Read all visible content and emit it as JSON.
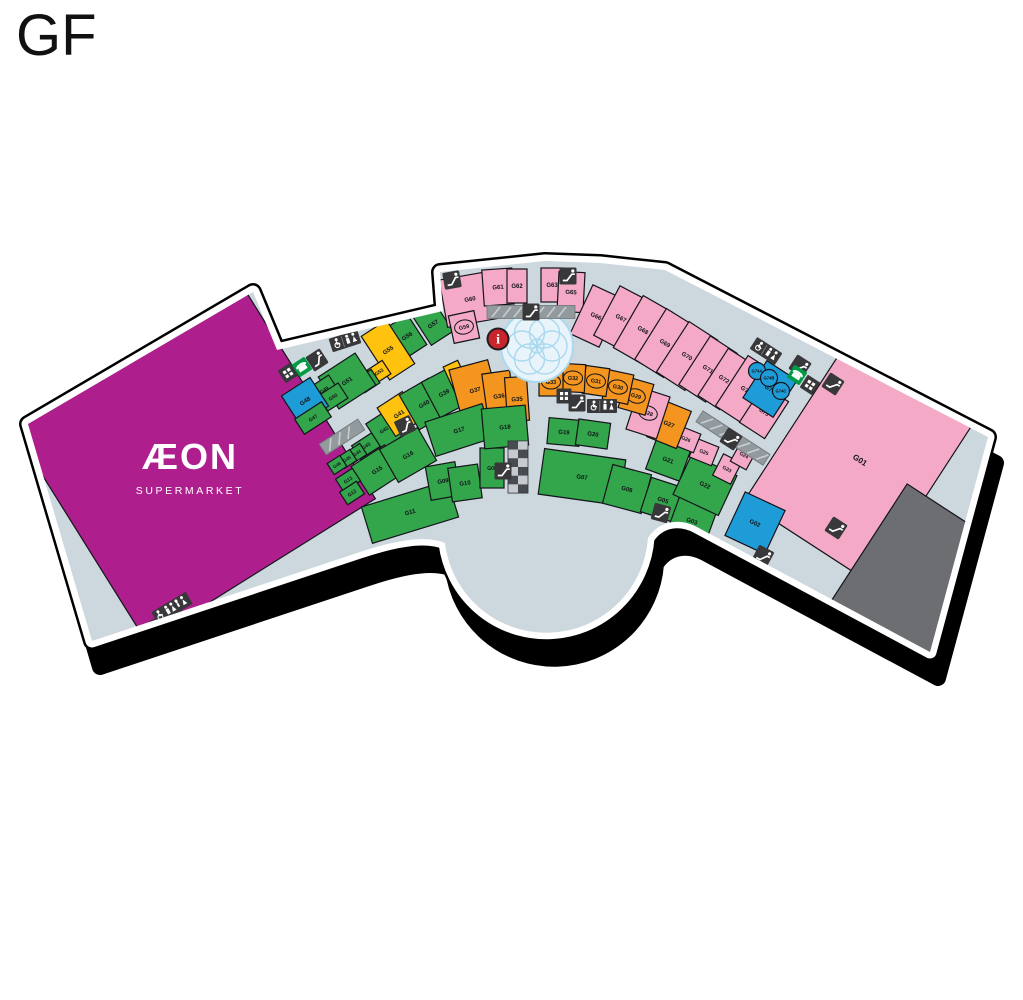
{
  "title": "GF",
  "aeon": {
    "name": "ÆON",
    "sub": "SUPERMARKET"
  },
  "colors": {
    "g": "#33a54b",
    "p": "#f4aac7",
    "o": "#f3951f",
    "y": "#ffc20e",
    "b": "#1e9cd7",
    "m": "#ae1e8d",
    "gr": "#6d6e71",
    "floor": "#ccd7de",
    "shadow": "#000000",
    "slab": "#ffffff",
    "iconDark": "#38383a",
    "phoneGreen": "#009a44",
    "infoRed": "#c9252c",
    "ramp": "#929a9d",
    "fountain": "#a9d9ef"
  },
  "units": [
    {
      "id": "AEON",
      "x": 192,
      "y": 460,
      "w": 270,
      "h": 260,
      "r": -32,
      "c": "m"
    },
    {
      "id": "G01",
      "x": 860,
      "y": 460,
      "w": 150,
      "h": 195,
      "r": 33,
      "c": "p",
      "fs": 8
    },
    {
      "id": "",
      "x": 925,
      "y": 585,
      "w": 140,
      "h": 150,
      "r": 33,
      "c": "gr"
    },
    {
      "id": "G02",
      "x": 755,
      "y": 523,
      "w": 44,
      "h": 48,
      "r": 25,
      "c": "b"
    },
    {
      "id": "G57",
      "x": 433,
      "y": 324,
      "w": 26,
      "h": 34,
      "r": -33,
      "c": "g"
    },
    {
      "id": "G56",
      "x": 407,
      "y": 336,
      "w": 24,
      "h": 36,
      "r": -33,
      "c": "g"
    },
    {
      "id": "G55",
      "x": 388,
      "y": 350,
      "w": 30,
      "h": 52,
      "r": -33,
      "c": "y"
    },
    {
      "id": "G53",
      "x": 379,
      "y": 372,
      "w": 18,
      "h": 16,
      "r": -33,
      "c": "y",
      "fs": 5
    },
    {
      "id": "G52",
      "x": 368,
      "y": 381,
      "w": 18,
      "h": 16,
      "r": -33,
      "c": "g",
      "fs": 5
    },
    {
      "id": "G51",
      "x": 347,
      "y": 381,
      "w": 44,
      "h": 38,
      "r": -33,
      "c": "g"
    },
    {
      "id": "G49",
      "x": 324,
      "y": 390,
      "w": 24,
      "h": 20,
      "r": -33,
      "c": "g",
      "fs": 5
    },
    {
      "id": "G50",
      "x": 333,
      "y": 397,
      "w": 24,
      "h": 18,
      "r": -33,
      "c": "g",
      "fs": 5
    },
    {
      "id": "G48",
      "x": 305,
      "y": 401,
      "w": 34,
      "h": 34,
      "r": -33,
      "c": "b"
    },
    {
      "id": "G47",
      "x": 313,
      "y": 418,
      "w": 32,
      "h": 18,
      "r": -33,
      "c": "g",
      "fs": 5
    },
    {
      "id": "G43",
      "x": 366,
      "y": 446,
      "w": 24,
      "h": 16,
      "r": -33,
      "c": "g",
      "fs": 5
    },
    {
      "id": "G44",
      "x": 357,
      "y": 453,
      "w": 15,
      "h": 13,
      "r": -33,
      "c": "g",
      "fs": 4.5
    },
    {
      "id": "G45",
      "x": 347,
      "y": 459,
      "w": 15,
      "h": 13,
      "r": -33,
      "c": "g",
      "fs": 4.5
    },
    {
      "id": "G46",
      "x": 337,
      "y": 465,
      "w": 15,
      "h": 13,
      "r": -33,
      "c": "g",
      "fs": 4.5
    },
    {
      "id": "G42",
      "x": 384,
      "y": 430,
      "w": 24,
      "h": 30,
      "r": -33,
      "c": "g",
      "fs": 5
    },
    {
      "id": "G41",
      "x": 399,
      "y": 414,
      "w": 30,
      "h": 34,
      "r": -33,
      "c": "y"
    },
    {
      "id": "G40",
      "x": 424,
      "y": 404,
      "w": 34,
      "h": 40,
      "r": -30,
      "c": "g"
    },
    {
      "id": "G39",
      "x": 444,
      "y": 393,
      "w": 30,
      "h": 40,
      "r": -28,
      "c": "g"
    },
    {
      "id": "G38",
      "x": 458,
      "y": 380,
      "w": 16,
      "h": 36,
      "r": -25,
      "c": "y",
      "fs": 5
    },
    {
      "id": "G37",
      "x": 475,
      "y": 390,
      "w": 40,
      "h": 52,
      "r": -15,
      "c": "o"
    },
    {
      "id": "G36",
      "x": 499,
      "y": 396,
      "w": 28,
      "h": 48,
      "r": -8,
      "c": "o"
    },
    {
      "id": "G35",
      "x": 517,
      "y": 399,
      "w": 22,
      "h": 44,
      "r": -4,
      "c": "o"
    },
    {
      "id": "G15",
      "x": 377,
      "y": 470,
      "w": 40,
      "h": 34,
      "r": -33,
      "c": "g"
    },
    {
      "id": "G13",
      "x": 348,
      "y": 480,
      "w": 20,
      "h": 15,
      "r": -33,
      "c": "g",
      "fs": 5
    },
    {
      "id": "G12",
      "x": 352,
      "y": 493,
      "w": 20,
      "h": 15,
      "r": -33,
      "c": "g",
      "fs": 5
    },
    {
      "id": "G16",
      "x": 408,
      "y": 455,
      "w": 44,
      "h": 38,
      "r": -30,
      "c": "g"
    },
    {
      "id": "G11",
      "x": 410,
      "y": 512,
      "w": 90,
      "h": 38,
      "r": -17,
      "c": "g"
    },
    {
      "id": "G09",
      "x": 443,
      "y": 481,
      "w": 30,
      "h": 34,
      "r": -10,
      "c": "g"
    },
    {
      "id": "G10",
      "x": 465,
      "y": 483,
      "w": 30,
      "h": 34,
      "r": -8,
      "c": "g"
    },
    {
      "id": "G08",
      "x": 492,
      "y": 468,
      "w": 24,
      "h": 40,
      "r": 0,
      "c": "g",
      "fs": 5
    },
    {
      "id": "G17",
      "x": 459,
      "y": 430,
      "w": 60,
      "h": 36,
      "r": -18,
      "c": "g"
    },
    {
      "id": "G18",
      "x": 505,
      "y": 427,
      "w": 44,
      "h": 40,
      "r": -5,
      "c": "g"
    },
    {
      "id": "G19",
      "x": 564,
      "y": 432,
      "w": 32,
      "h": 26,
      "r": 5,
      "c": "g"
    },
    {
      "id": "G20",
      "x": 593,
      "y": 434,
      "w": 32,
      "h": 26,
      "r": 8,
      "c": "g"
    },
    {
      "id": "G07",
      "x": 582,
      "y": 477,
      "w": 82,
      "h": 46,
      "r": 8,
      "c": "g"
    },
    {
      "id": "G06",
      "x": 627,
      "y": 489,
      "w": 40,
      "h": 40,
      "r": 15,
      "c": "g"
    },
    {
      "id": "G05",
      "x": 663,
      "y": 500,
      "w": 36,
      "h": 36,
      "r": 18,
      "c": "g"
    },
    {
      "id": "G03",
      "x": 692,
      "y": 521,
      "w": 40,
      "h": 40,
      "r": 20,
      "c": "g"
    },
    {
      "id": "G21",
      "x": 668,
      "y": 460,
      "w": 36,
      "h": 32,
      "r": 20,
      "c": "g"
    },
    {
      "id": "G22",
      "x": 705,
      "y": 485,
      "w": 50,
      "h": 44,
      "r": 25,
      "c": "g"
    },
    {
      "id": "G23",
      "x": 727,
      "y": 469,
      "w": 20,
      "h": 24,
      "r": 27,
      "c": "p",
      "fs": 5
    },
    {
      "id": "G24",
      "x": 744,
      "y": 455,
      "w": 18,
      "h": 24,
      "r": 29,
      "c": "p",
      "fs": 5
    },
    {
      "id": "G25",
      "x": 704,
      "y": 452,
      "w": 24,
      "h": 20,
      "r": 22,
      "c": "p",
      "fs": 5
    },
    {
      "id": "G26",
      "x": 686,
      "y": 439,
      "w": 24,
      "h": 20,
      "r": 22,
      "c": "p",
      "fs": 5
    },
    {
      "id": "G27",
      "x": 669,
      "y": 424,
      "w": 32,
      "h": 40,
      "r": 22,
      "c": "o"
    },
    {
      "id": "G28",
      "x": 648,
      "y": 413,
      "w": 32,
      "h": 44,
      "r": 18,
      "c": "p",
      "fs": 5.5,
      "ring": true
    },
    {
      "id": "G29",
      "x": 636,
      "y": 396,
      "w": 28,
      "h": 32,
      "r": 16,
      "c": "o",
      "fs": 5.5,
      "ring": true
    },
    {
      "id": "G30",
      "x": 618,
      "y": 387,
      "w": 26,
      "h": 30,
      "r": 12,
      "c": "o",
      "fs": 5.5,
      "ring": true
    },
    {
      "id": "G31",
      "x": 596,
      "y": 381,
      "w": 24,
      "h": 28,
      "r": 8,
      "c": "o",
      "fs": 5.5,
      "ring": true
    },
    {
      "id": "G32",
      "x": 573,
      "y": 378,
      "w": 24,
      "h": 28,
      "r": 3,
      "c": "o",
      "fs": 5.5,
      "ring": true
    },
    {
      "id": "G33",
      "x": 551,
      "y": 382,
      "w": 24,
      "h": 28,
      "r": 0,
      "c": "o",
      "fs": 5.5,
      "ring": true
    },
    {
      "id": "G60",
      "x": 470,
      "y": 299,
      "w": 54,
      "h": 48,
      "r": -10,
      "c": "p"
    },
    {
      "id": "G59",
      "x": 464,
      "y": 327,
      "w": 26,
      "h": 28,
      "r": -12,
      "c": "p",
      "fs": 5.5,
      "ring": true
    },
    {
      "id": "G61",
      "x": 498,
      "y": 287,
      "w": 30,
      "h": 36,
      "r": -4,
      "c": "p"
    },
    {
      "id": "G62",
      "x": 517,
      "y": 286,
      "w": 20,
      "h": 34,
      "r": 0,
      "c": "p"
    },
    {
      "id": "G63",
      "x": 552,
      "y": 285,
      "w": 22,
      "h": 34,
      "r": 0,
      "c": "p"
    },
    {
      "id": "G65",
      "x": 571,
      "y": 292,
      "w": 26,
      "h": 40,
      "r": 3,
      "c": "p"
    },
    {
      "id": "G66",
      "x": 596,
      "y": 316,
      "w": 32,
      "h": 54,
      "r": 25,
      "c": "p"
    },
    {
      "id": "G67",
      "x": 621,
      "y": 318,
      "w": 32,
      "h": 56,
      "r": 28,
      "c": "p"
    },
    {
      "id": "G68",
      "x": 643,
      "y": 330,
      "w": 34,
      "h": 60,
      "r": 30,
      "c": "p"
    },
    {
      "id": "G69",
      "x": 665,
      "y": 343,
      "w": 34,
      "h": 60,
      "r": 32,
      "c": "p"
    },
    {
      "id": "G70",
      "x": 687,
      "y": 356,
      "w": 34,
      "h": 60,
      "r": 33,
      "c": "p"
    },
    {
      "id": "G71",
      "x": 708,
      "y": 369,
      "w": 32,
      "h": 58,
      "r": 33,
      "c": "p"
    },
    {
      "id": "G72",
      "x": 724,
      "y": 379,
      "w": 26,
      "h": 56,
      "r": 33,
      "c": "p"
    },
    {
      "id": "G73",
      "x": 746,
      "y": 390,
      "w": 34,
      "h": 60,
      "r": 33,
      "c": "p"
    },
    {
      "id": "G75",
      "x": 764,
      "y": 412,
      "w": 30,
      "h": 44,
      "r": 33,
      "c": "p",
      "fs": 5.5
    },
    {
      "id": "G76",
      "x": 770,
      "y": 389,
      "w": 36,
      "h": 44,
      "r": 33,
      "c": "b"
    }
  ],
  "kiosks": [
    {
      "id": "G74A",
      "x": 757,
      "y": 371,
      "rad": 8.5,
      "c": "b"
    },
    {
      "id": "G74B",
      "x": 769,
      "y": 378,
      "rad": 8.5,
      "c": "b"
    },
    {
      "id": "G74C",
      "x": 781,
      "y": 391,
      "rad": 8.5,
      "c": "b"
    }
  ],
  "icons": [
    {
      "t": "ramp",
      "x": 342,
      "y": 437,
      "r": -33,
      "w": 46
    },
    {
      "t": "ramp",
      "x": 531,
      "y": 312,
      "r": 0,
      "w": 88
    },
    {
      "t": "ramp",
      "x": 733,
      "y": 438,
      "r": 33,
      "w": 80
    },
    {
      "t": "stairs",
      "x": 518,
      "y": 467,
      "r": 0
    },
    {
      "t": "esc",
      "x": 317,
      "y": 360,
      "r": -33
    },
    {
      "t": "esc",
      "x": 452,
      "y": 280,
      "r": -10
    },
    {
      "t": "esc",
      "x": 568,
      "y": 276,
      "r": 0
    },
    {
      "t": "esc",
      "x": 531,
      "y": 312,
      "r": 0
    },
    {
      "t": "esc",
      "x": 405,
      "y": 426,
      "r": -25
    },
    {
      "t": "esc",
      "x": 503,
      "y": 471,
      "r": 0
    },
    {
      "t": "esc",
      "x": 577,
      "y": 403,
      "r": 0
    },
    {
      "t": "esc",
      "x": 731,
      "y": 439,
      "r": 33
    },
    {
      "t": "esc",
      "x": 661,
      "y": 513,
      "r": 15
    },
    {
      "t": "esc",
      "x": 763,
      "y": 556,
      "r": 28
    },
    {
      "t": "esc",
      "x": 836,
      "y": 528,
      "r": 33
    },
    {
      "t": "esc",
      "x": 800,
      "y": 366,
      "r": 33
    },
    {
      "t": "esc",
      "x": 833,
      "y": 384,
      "r": 33
    },
    {
      "t": "esc",
      "x": 179,
      "y": 621,
      "r": -31
    },
    {
      "t": "atm",
      "x": 288,
      "y": 373,
      "r": -33
    },
    {
      "t": "atm",
      "x": 564,
      "y": 396,
      "r": 0
    },
    {
      "t": "atm",
      "x": 810,
      "y": 385,
      "r": 33
    },
    {
      "t": "atm",
      "x": 158,
      "y": 625,
      "r": -31
    },
    {
      "t": "phone",
      "x": 302,
      "y": 367,
      "r": -33
    },
    {
      "t": "phone",
      "x": 797,
      "y": 375,
      "r": 33
    },
    {
      "t": "wc",
      "x": 345,
      "y": 341,
      "r": -18
    },
    {
      "t": "wc",
      "x": 602,
      "y": 406,
      "r": 0
    },
    {
      "t": "wc",
      "x": 766,
      "y": 351,
      "r": 33
    },
    {
      "t": "wc3",
      "x": 172,
      "y": 608,
      "r": -31
    },
    {
      "t": "info",
      "x": 498,
      "y": 339,
      "r": 0
    }
  ],
  "fountain": {
    "x": 537,
    "y": 346,
    "rad": 36
  }
}
